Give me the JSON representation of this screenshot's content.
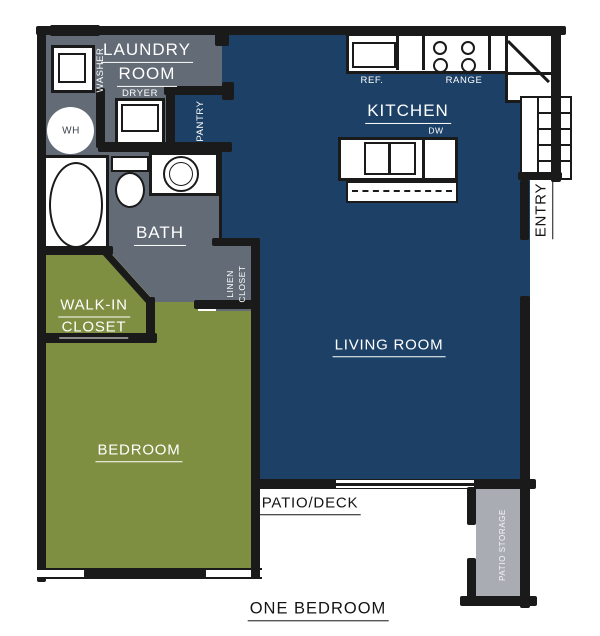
{
  "plan": {
    "title": "ONE BEDROOM",
    "type": "floor-plan"
  },
  "colors": {
    "wall": "#1a1a1a",
    "room_blue": "#1d4166",
    "room_gray": "#636b76",
    "room_green": "#7e8f41",
    "storage_gray": "#a9adb3",
    "label_light": "#ffffff",
    "label_dark": "#141414"
  },
  "rooms": {
    "laundry": {
      "line1": "LAUNDRY",
      "line2": "ROOM"
    },
    "bath": {
      "label": "BATH"
    },
    "kitchen": {
      "label": "KITCHEN"
    },
    "living": {
      "label": "LIVING ROOM"
    },
    "bedroom": {
      "label": "BEDROOM"
    },
    "walk_in": {
      "line1": "WALK-IN",
      "line2": "CLOSET"
    },
    "linen": {
      "line1": "LINEN",
      "line2": "CLOSET"
    },
    "pantry": {
      "label": "PANTRY"
    },
    "entry": {
      "label": "ENTRY"
    },
    "patio": {
      "label": "PATIO/DECK"
    },
    "storage": {
      "label": "PATIO STORAGE"
    }
  },
  "fixtures": {
    "washer": "WASHER",
    "dryer": "DRYER",
    "water_heater": "WH",
    "refrigerator": "REF.",
    "range": "RANGE",
    "dishwasher": "DW"
  }
}
